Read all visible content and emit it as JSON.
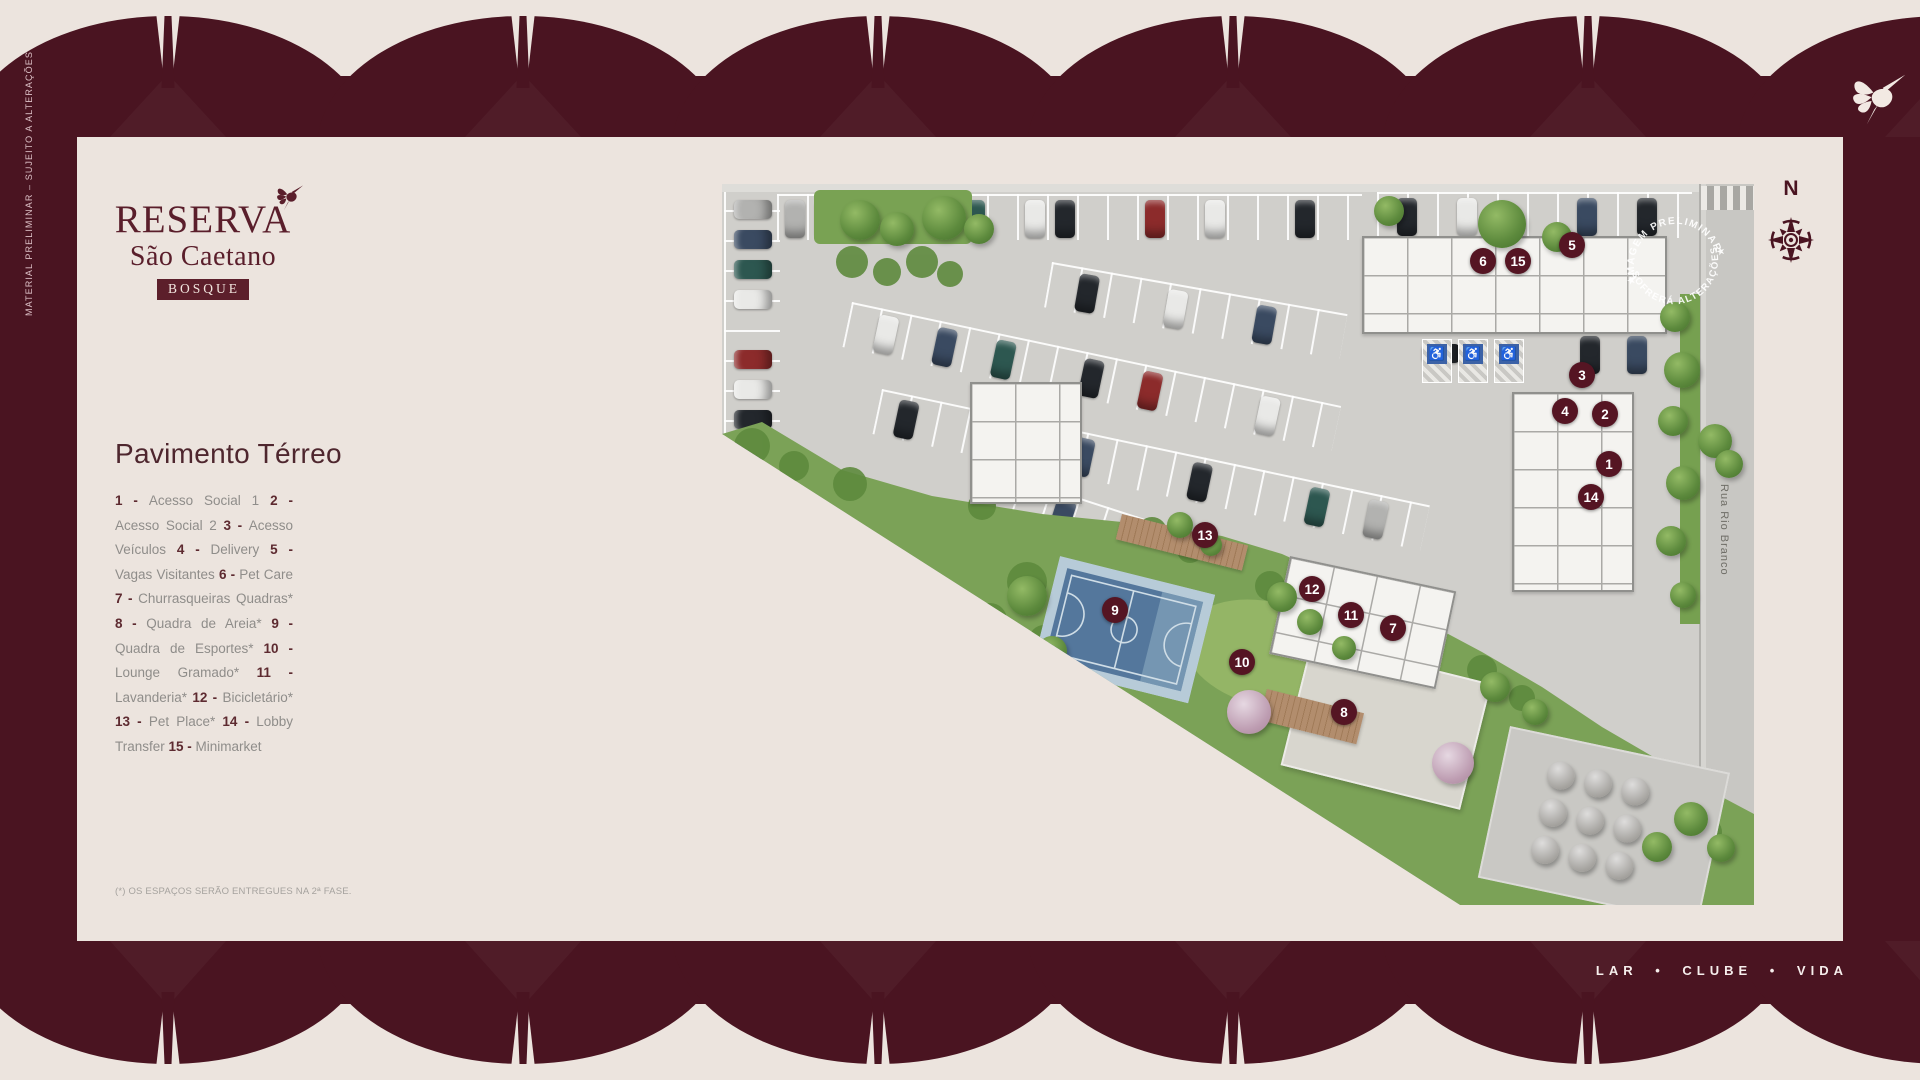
{
  "frame": {
    "side_note": "MATERIAL PRELIMINAR – SUJEITO A ALTERAÇÕES",
    "tagline": "LAR • CLUBE • VIDA"
  },
  "logo": {
    "name": "RESERVA",
    "subname": "São Caetano",
    "badge": "BOSQUE"
  },
  "compass": {
    "label": "N"
  },
  "sidebar": {
    "title": "Pavimento Térreo",
    "footnote": "(*) OS ESPAÇOS SERÃO ENTREGUES NA 2ª FASE.",
    "legend": [
      {
        "num": "1",
        "label": "Acesso Social 1"
      },
      {
        "num": "2",
        "label": "Acesso Social 2"
      },
      {
        "num": "3",
        "label": "Acesso Veículos"
      },
      {
        "num": "4",
        "label": "Delivery"
      },
      {
        "num": "5",
        "label": "Vagas Visitantes"
      },
      {
        "num": "6",
        "label": "Pet Care"
      },
      {
        "num": "7",
        "label": "Churrasqueiras Quadras*"
      },
      {
        "num": "8",
        "label": "Quadra de Areia*"
      },
      {
        "num": "9",
        "label": "Quadra de Esportes*"
      },
      {
        "num": "10",
        "label": "Lounge Gramado*"
      },
      {
        "num": "11",
        "label": "Lavanderia*"
      },
      {
        "num": "12",
        "label": "Bicicletário*"
      },
      {
        "num": "13",
        "label": "Pet Place*"
      },
      {
        "num": "14",
        "label": "Lobby Transfer"
      },
      {
        "num": "15",
        "label": "Minimarket"
      }
    ]
  },
  "plan": {
    "street": "Rua Rio Branco",
    "watermark": {
      "top": "IMAGEM PRELIMINAR",
      "bottom": "SOFRERÁ ALTERAÇÕES"
    },
    "markers": [
      {
        "num": "1",
        "x": 887,
        "y": 280
      },
      {
        "num": "2",
        "x": 883,
        "y": 230
      },
      {
        "num": "3",
        "x": 860,
        "y": 191
      },
      {
        "num": "4",
        "x": 843,
        "y": 227
      },
      {
        "num": "5",
        "x": 850,
        "y": 61
      },
      {
        "num": "6",
        "x": 761,
        "y": 77
      },
      {
        "num": "7",
        "x": 671,
        "y": 444
      },
      {
        "num": "8",
        "x": 622,
        "y": 528
      },
      {
        "num": "9",
        "x": 393,
        "y": 426
      },
      {
        "num": "10",
        "x": 520,
        "y": 478
      },
      {
        "num": "11",
        "x": 629,
        "y": 431
      },
      {
        "num": "12",
        "x": 590,
        "y": 405
      },
      {
        "num": "13",
        "x": 483,
        "y": 351
      },
      {
        "num": "14",
        "x": 869,
        "y": 313
      },
      {
        "num": "15",
        "x": 796,
        "y": 77
      }
    ]
  },
  "colors": {
    "maroon": "#4a1421",
    "cream": "#ece4de",
    "marker": "#551523",
    "logo": "#5a1e2b"
  }
}
